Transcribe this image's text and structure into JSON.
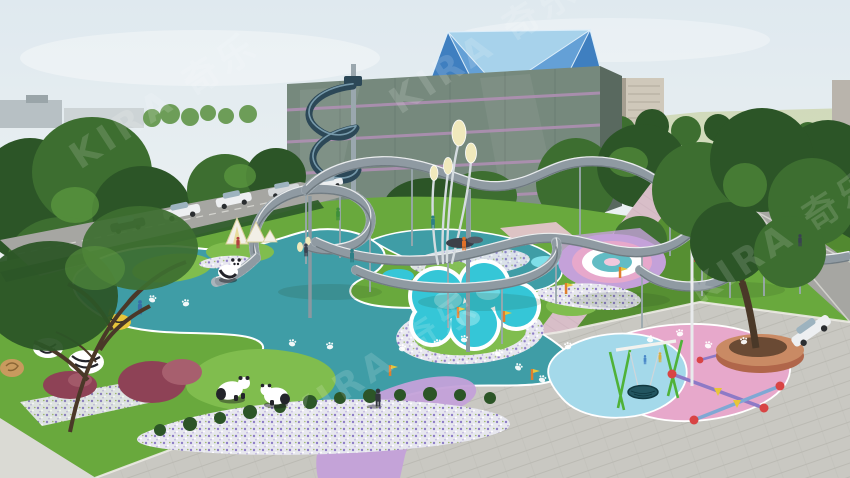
{
  "scene": {
    "type": "3d-architectural-rendering",
    "subject": "panda-themed children's playground park with looping elevated walkway, spiral slide, tulip lamps, swings, seesaws and glass building"
  },
  "watermark": {
    "text": "KIRA 奇乐"
  },
  "palette": {
    "sky_top": "#dfe9ef",
    "sky_bot": "#f7f8f5",
    "field": "#ccd6ae",
    "horizon_bldg": "#b7c0c4",
    "horizon_bldg2": "#cdd4d6",
    "treedark": "#2c5527",
    "tree": "#3d6e30",
    "treelight": "#5d9a40",
    "bush": "#2e5b29",
    "glass": "#76897d",
    "glass_light": "#96a698",
    "stripe": "#b18fb5",
    "side": "#59695f",
    "crown1": "#a7d2eb",
    "crown2": "#64a0d6",
    "crown3": "#3f7fc0",
    "crown_edge": "#ddeefa",
    "hirise": "#cfc8ba",
    "hirise_sh": "#a59e90",
    "slide": "#2c4857",
    "slide_hi": "#84a8b8",
    "pole": "#9aa7ae",
    "deck": "#c6cdd3",
    "rail": "#a9b4bb",
    "deck_dark": "#5b656c",
    "grass": "#69a93d",
    "grass_light": "#80bd4e",
    "grass_dark": "#568f32",
    "teal": "#3f9da6",
    "teal_light": "#62bcc4",
    "cyan": "#35c6d7",
    "cyan_light": "#7fdfe9",
    "pink": "#e7a8cb",
    "pink_pale": "#f2c8dc",
    "lavender": "#c4a1d9",
    "lblue": "#a4d9ea",
    "plaza": "#c9c8c2",
    "plaza_line": "#b0afa8",
    "sidewalk": "#dadad4",
    "road": "#a6a6a2",
    "pinkpath": "#d8bec8",
    "flowerbg": "#e7e7ef",
    "flower": "#8d7cc6",
    "lamp": "#f0e9bc",
    "white": "#ffffff",
    "ink": "#23242a",
    "swing": "#4fb238",
    "seesaw": "#8d7ac6",
    "red": "#d84444",
    "orange": "#df7e2e",
    "yellow": "#e8c53a",
    "planter": "#b0664a",
    "planter_hi": "#c98a64",
    "trunk": "#4a3828",
    "car": "#edeff1",
    "car_dark": "#394047",
    "silver": "#d5d8da",
    "glass_car": "#9db3bf",
    "red_tree": "#8e4256",
    "red_tree_hi": "#a75f6e",
    "people": "#3a4250",
    "watermark": "#ffffff"
  }
}
